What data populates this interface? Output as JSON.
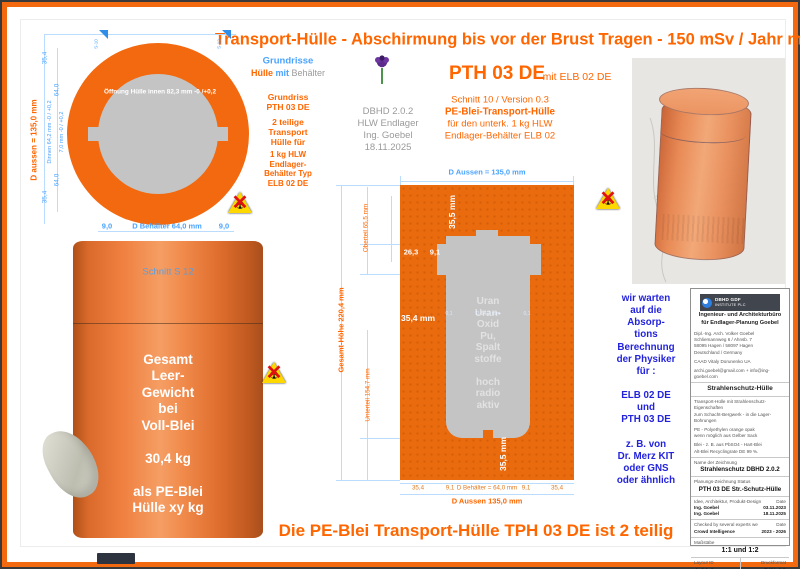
{
  "colors": {
    "accent_orange": "#ff6600",
    "shell_orange": "#f2690f",
    "dim_blue": "#4aa3ff",
    "note_blue": "#2323dd",
    "text_gray": "#9a9a9a",
    "container_gray": "#c4c4c4"
  },
  "header": {
    "title": "Transport-Hülle - Abschirmung bis vor der Brust Tragen - 150 mSv / Jahr max."
  },
  "footer": {
    "title": "Die PE-Blei Transport-Hülle TPH 03 DE ist 2 teilig"
  },
  "plan": {
    "marker_left": "S-10",
    "marker_right": "S-12",
    "opening_label": "Öffnung Hülle innen 82,3 mm -0 /+0,2",
    "d_aussen": "D aussen = 135,0 mm",
    "dim_354_top": "35,4",
    "dim_640_top": "64,0",
    "dinnen": "Dinnen 64,2 mm -0 / +0,2",
    "wall": "7,0 mm -0 / +0,2",
    "dim_640_bottom": "64,0",
    "dim_354_bottom": "35,4",
    "bottom_left": "9,0",
    "bottom_center": "D Behälter 64,0 mm",
    "bottom_right": "9,0"
  },
  "notes_left": {
    "heading": "Grundrisse",
    "sub_orange": "Hülle",
    "sub_blue": " mit ",
    "sub_gray": "Behälter",
    "block1": "Grundriss\nPTH 03 DE",
    "block2": "2 teilige\nTransport\nHülle für",
    "block3": "1 kg HLW\nEndlager-\nBehälter Typ\nELB 02 DE"
  },
  "doc_info": {
    "lines": "DBHD 2.0.2\nHLW Endlager\nIng. Goebel\n18.11.2025"
  },
  "heading": {
    "main": "PTH 03 DE",
    "suffix": "mit ELB 02 DE",
    "sub1": "Schnitt 10 / Version 0.3",
    "sub2": "PE-Blei-Transport-Hülle",
    "sub3": "für den unterk. 1 kg HLW",
    "sub4": "Endlager-Behälter ELB 02"
  },
  "section": {
    "top_dim": "D Aussen = 135,0 mm",
    "h_total": "Gesamt-Höhe  220,4 mm",
    "h_top": "Oberteil 65,5 mm",
    "h_bottom": "Unterteil 154,7 mm",
    "lid_height": "35,5 mm",
    "dim_263": "26,3",
    "dim_91": "9,1",
    "wall_354": "35,4 mm",
    "bottom_355": "35,5 mm",
    "inner_tol_left": "0,1",
    "inner_dim": "D 64,2 mm",
    "inner_tol_right": "0,1",
    "content": "Uran\nUran-\nOxid\nPu,\nSpalt\nstoffe\n\nhoch\nradio\naktiv",
    "dims_bottom": [
      "35,4",
      "9,1",
      "D Behälter = 64,0 mm",
      "9,1",
      "35,4"
    ],
    "bottom_dim": "D Aussen 135,0 mm"
  },
  "cylinder": {
    "section_label": "Schnitt S 12",
    "weight_text": "Gesamt\nLeer-\nGewicht\nbei\nVoll-Blei\n\n30,4 kg\n\nals PE-Blei\nHülle xy kg"
  },
  "notes_right": {
    "text": "wir warten\nauf die\nAbsorp-\ntions\nBerechnung\nder Physiker\nfür :\n\nELB 02 DE\nund\nPTH 03 DE\n\nz. B. von\nDr. Merz KIT\noder GNS\noder ähnlich"
  },
  "titleblock": {
    "logo_line1": "DBHD GDF",
    "logo_line2": "INSTITUTE PLC",
    "office": "Ingenieur- und Architekturbüro\nfür Endlager-Planung Goebel",
    "address": "Dipl.-Ing. Arch. Volker Goebel\nSchliemannweg 6 / Ahnsb. 7\n58095 Hagen / 58097 Hagen\nDeutschland / Germany",
    "caad": "CAAD Vitaly Dorunenko UA",
    "email": "archi.goebel@gmail.com + info@ing-goebel.com",
    "subject": "Strahlenschutz-Hülle",
    "desc1": "Transport-Hülle mit Strahlenschutz-Eigenschaften\nzum Schacht-Bergwerk - in die Lager-Bohrungen",
    "desc2": "PE - Polyethylen orange opak\nwenn möglich aus Gelber Sack",
    "desc3": "Blei - z. B. aus PbSO4 - Hart-Blei\nAlt-Blei Recyclingrate DE 99 %.",
    "name_label": "Name der Zeichnung",
    "name_value": "Strahlenschutz DBHD 2.0.2",
    "status_label": "Planungs-Zeichnung Status",
    "status_value": "PTH 03 DE Str.-Schutz-Hülle",
    "row1_label": "Idee, Architektur, Produkt-Design",
    "row1_value": "Date",
    "row2_label": "Ing. Goebel",
    "row2_value": "03.11.2023",
    "row3_label": "Ing. Goebel",
    "row3_value": "18.11.2025",
    "row4_label": "Checked by several experts we",
    "row4_value": "Date",
    "row5_label": "Crowd Intelligence",
    "row5_value": "2023 - 2026",
    "scale_label": "Maßstäbe",
    "scale_value": "1:1 und 1:2",
    "layout_label": "Layout ID",
    "layout_value": "A.01.1",
    "format_label": "Druckformat",
    "format_value": "DIN A2"
  }
}
